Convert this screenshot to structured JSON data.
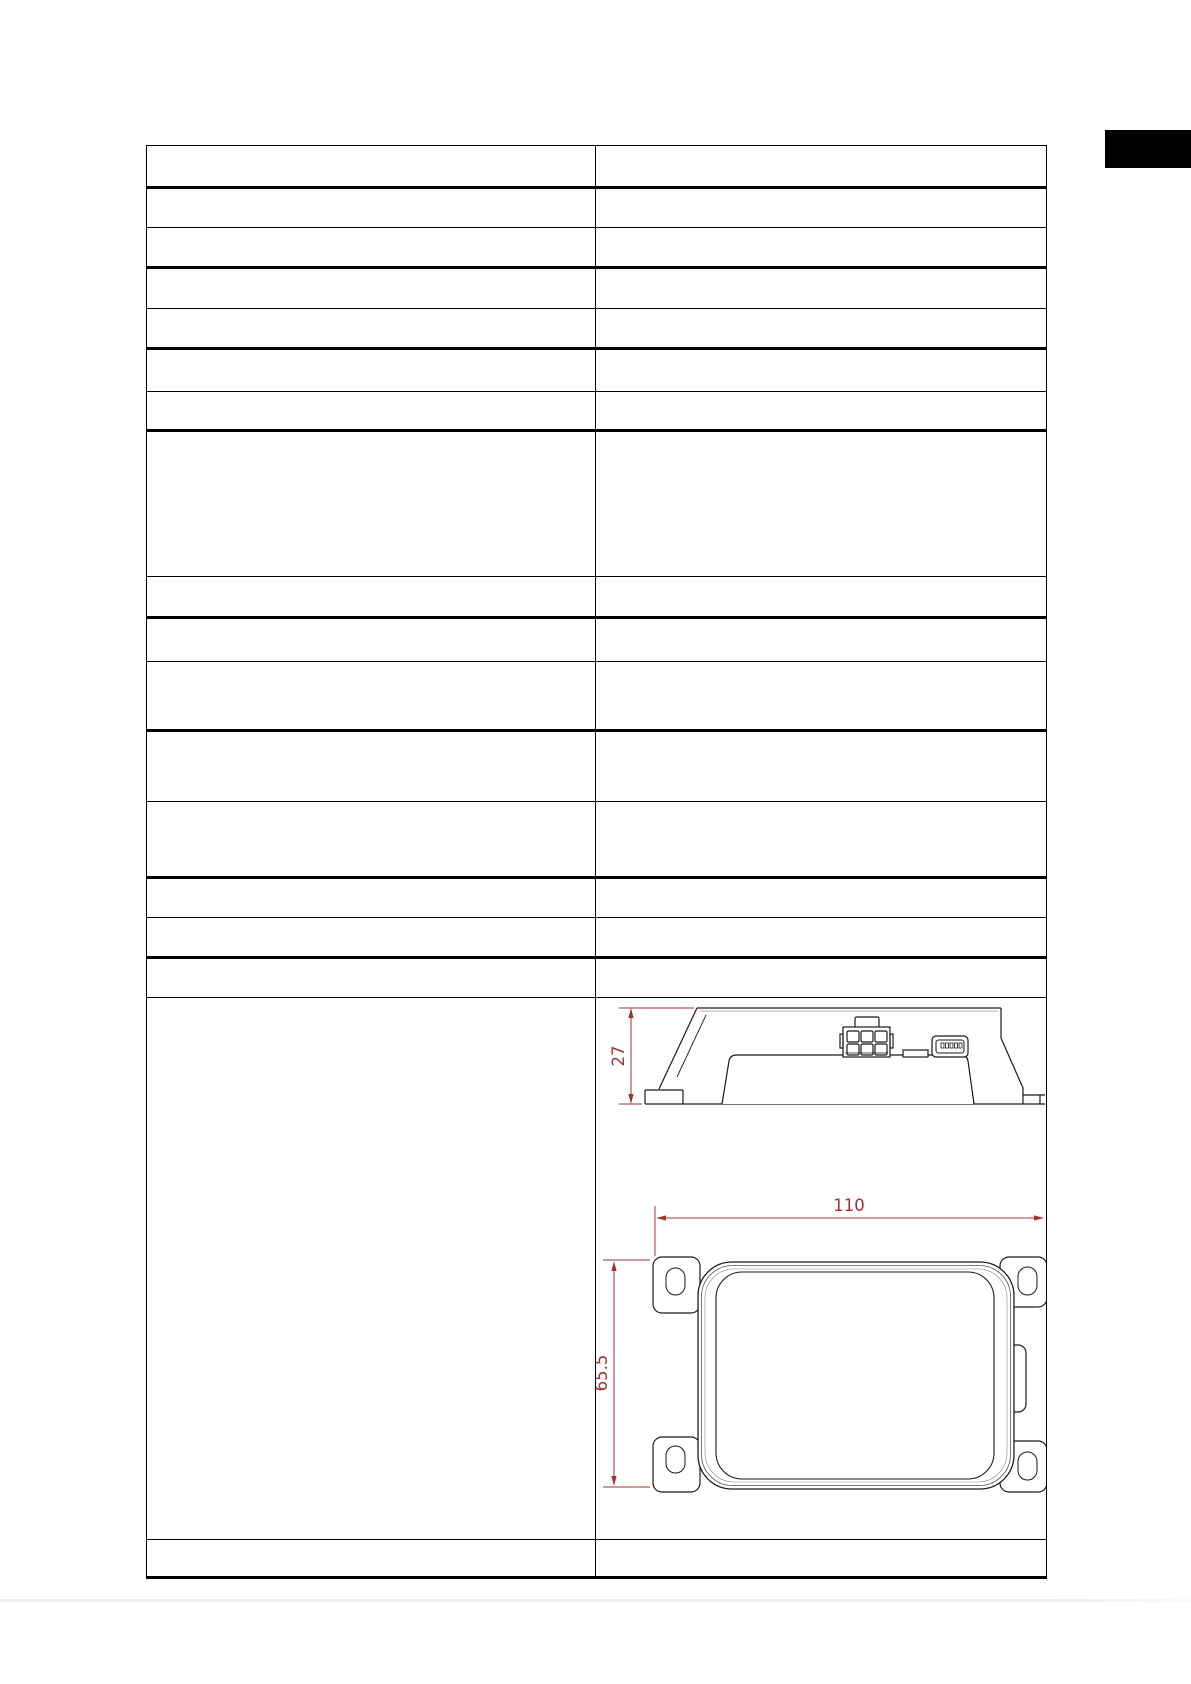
{
  "page": {
    "background_color": "#ffffff",
    "bottom_edge_rule_color": "#ececec"
  },
  "section_tab_marker": {
    "color": "#000000"
  },
  "spec_table": {
    "column_count": 2,
    "row_count": 18,
    "border_color": "#000000",
    "content": ""
  },
  "technical_drawing": {
    "line_color": "#1a1a1a",
    "dimension_color": "#a03232",
    "views": [
      "side view",
      "top view"
    ],
    "dimensions": {
      "height": "27",
      "width": "110",
      "depth": "65.5"
    },
    "features": [
      "six-pin-connector",
      "mini-usb-port",
      "mounting-tabs"
    ]
  }
}
